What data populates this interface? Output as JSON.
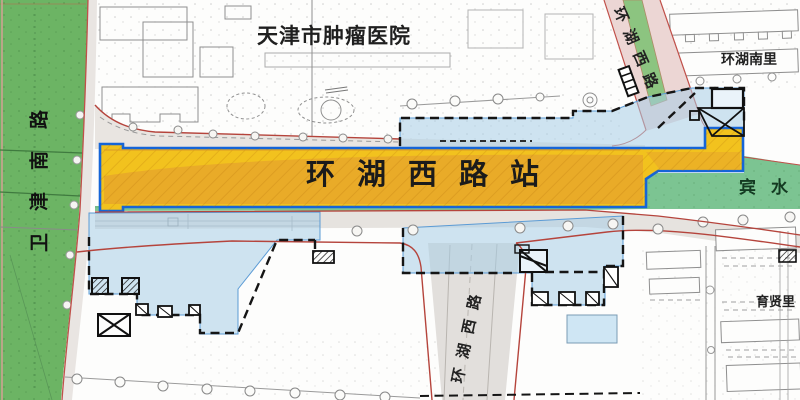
{
  "map": {
    "labels": {
      "hospital": "天津市肿瘤医院",
      "station": "环湖西路站",
      "road_weijin_south": "卫津南路",
      "road_huanhu_west_ne": "环湖西路",
      "road_huanhu_west_south": "环湖西路",
      "binshui_green": "宾水",
      "huanhu_nanli": "环湖南里",
      "yuxian_li": "育贤里"
    },
    "colors": {
      "station_fill": "#F2C21E",
      "station_inner": "#E8A72A",
      "station_border": "#1565D8",
      "reserved_zone_fill": "#A8CEE5",
      "boundary_dash": "#151515",
      "greenbelt_west": "#6CB464",
      "greenbelt_binshui": "#7CC492",
      "road_median_green": "#8CC480",
      "curb_red": "#B5443C",
      "road_grey": "#E6E3DF",
      "road_pink": "#ECD6D4",
      "building_outline": "#8F8F8F"
    }
  }
}
